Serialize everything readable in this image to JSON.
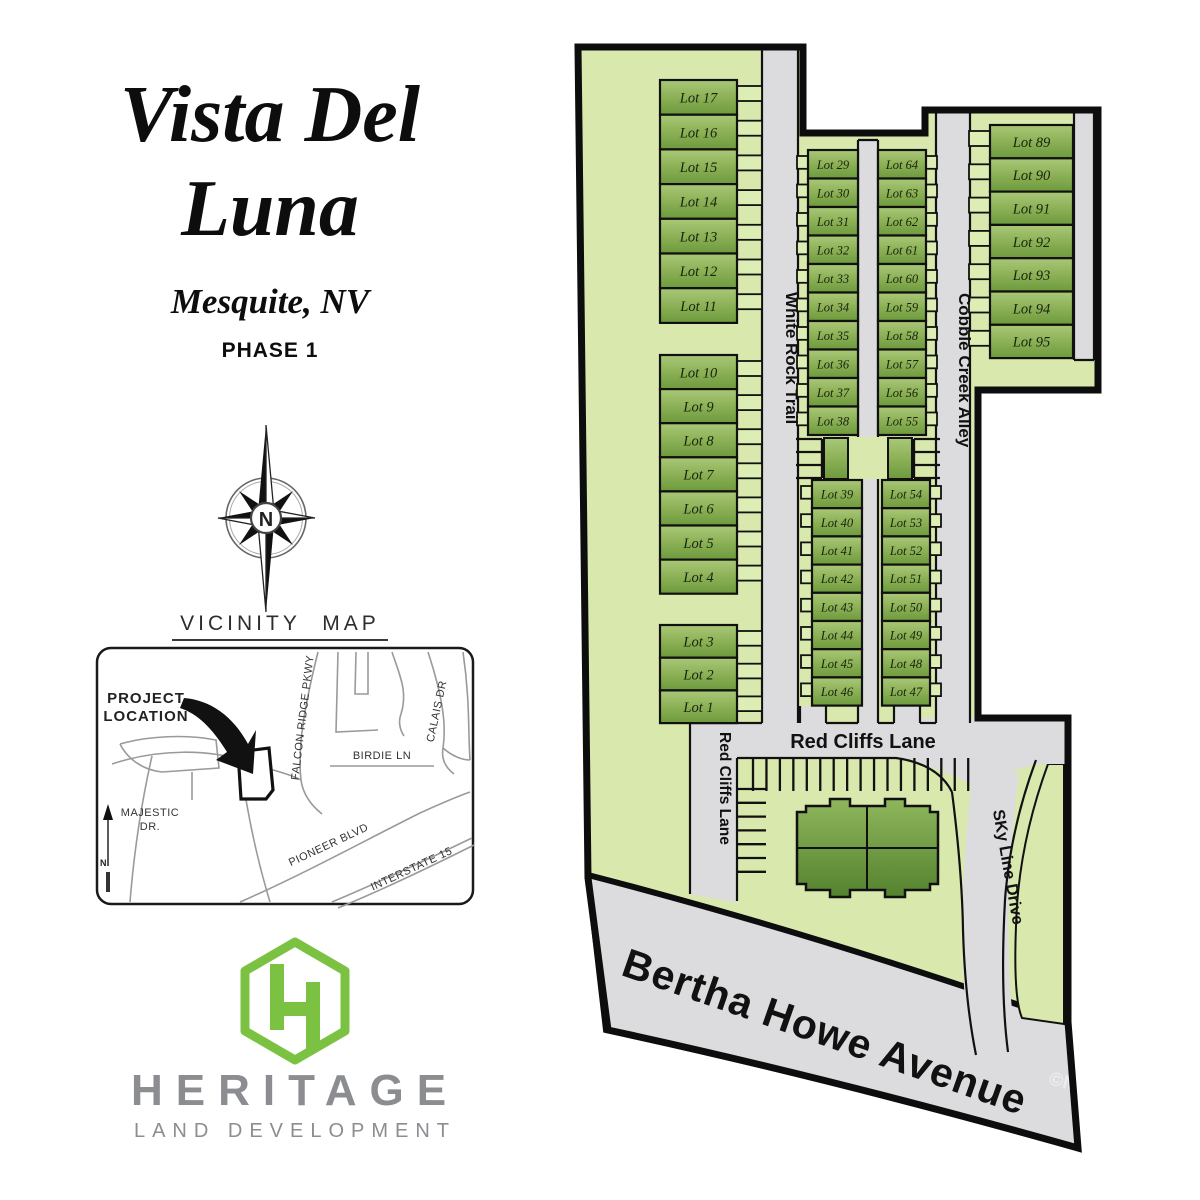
{
  "panel": {
    "title1": "Vista Del",
    "title2": "Luna",
    "city": "Mesquite, NV",
    "phase": "PHASE 1",
    "compass_n": "N"
  },
  "vicinity": {
    "title": "VICINITY MAP",
    "project1": "PROJECT",
    "project2": "LOCATION",
    "falcon": "FALCON RIDGE PKWY",
    "birdie": "BIRDIE LN",
    "calais": "CALAIS DR",
    "majestic1": "MAJESTIC",
    "majestic2": "DR.",
    "pioneer": "PIONEER BLVD",
    "interstate": "INTERSTATE 15",
    "north": "N"
  },
  "logo": {
    "word": "HERITAGE",
    "tagline": "LAND DEVELOPMENT"
  },
  "site_plan": {
    "lot_prefix": "Lot",
    "streets": {
      "white_rock": "White Rock Trail",
      "cobble": "Cobble Creek Alley",
      "red_h": "Red Cliffs Lane",
      "red_v": "Red Cliffs Lane",
      "sky": "SKy Line Drive",
      "bertha": "Bertha Howe Avenue"
    },
    "lots": {
      "left_top": [
        17,
        16,
        15,
        14,
        13,
        12,
        11
      ],
      "left_mid": [
        10,
        9,
        8,
        7,
        6,
        5,
        4
      ],
      "left_bottom": [
        3,
        2,
        1
      ],
      "a_top": [
        29,
        30,
        31,
        32,
        33,
        34,
        35,
        36,
        37,
        38
      ],
      "a_bottom": [
        39,
        40,
        41,
        42,
        43,
        44,
        45,
        46
      ],
      "b_top": [
        64,
        63,
        62,
        61,
        60,
        59,
        58,
        57,
        56,
        55
      ],
      "b_bottom": [
        54,
        53,
        52,
        51,
        50,
        49,
        48,
        47
      ],
      "right_col": [
        89,
        90,
        91,
        92,
        93,
        94,
        95
      ]
    },
    "watermark": "©M"
  },
  "colors": {
    "heritage_green": "#7cc242",
    "logo_gray": "#8b8d90",
    "parcel_green": "#d9e9ae",
    "lot_green_light": "#a9c878",
    "lot_green_dark": "#6d9a3c",
    "road_gray": "#dcdcde",
    "ink": "#111111"
  }
}
